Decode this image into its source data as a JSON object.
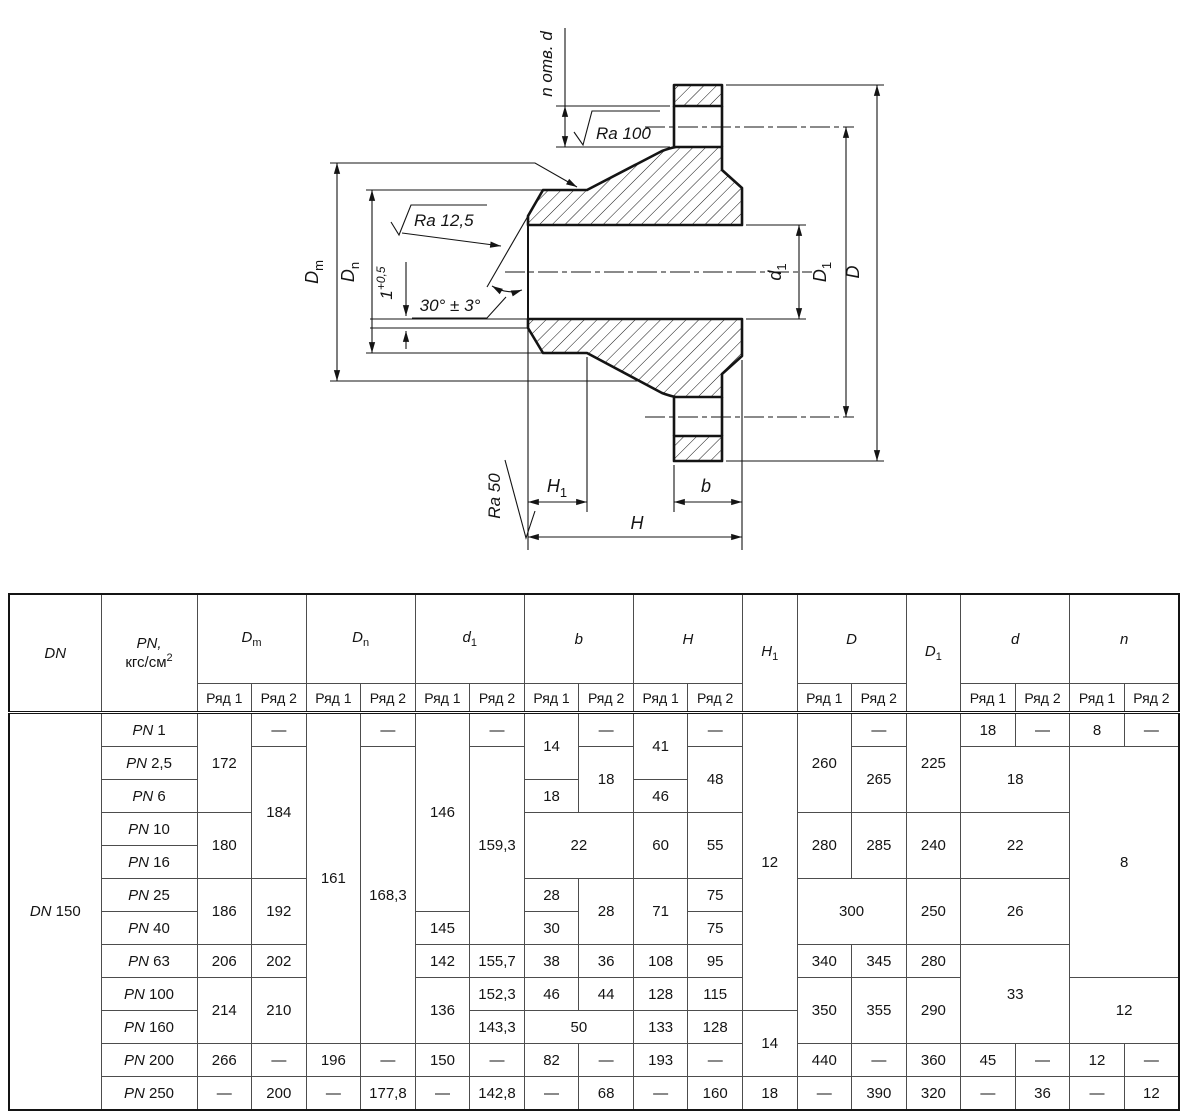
{
  "drawing": {
    "callouts": {
      "holes": "n отв. d",
      "ra_spotface": "Ra 100",
      "ra_bevel": "Ra 12,5",
      "ra_end": "Ra 50",
      "bevel_angle": "30° ± 3°",
      "land": {
        "value": "1",
        "tolerance": "+0,5"
      }
    },
    "dimensions": {
      "dm": {
        "base": "D",
        "sub": "m"
      },
      "dn": {
        "base": "D",
        "sub": "n"
      },
      "d1": {
        "base": "d",
        "sub": "1"
      },
      "b": {
        "base": "b",
        "sub": ""
      },
      "h": {
        "base": "H",
        "sub": ""
      },
      "h1": {
        "base": "H",
        "sub": "1"
      },
      "dbig": {
        "base": "D",
        "sub": ""
      },
      "dbig1": {
        "base": "D",
        "sub": "1"
      }
    }
  },
  "table": {
    "dn": {
      "prefix": "DN",
      "value": "150"
    },
    "header": {
      "dn": "DN",
      "pn_line1": "PN,",
      "pn_line2": "кгс/см",
      "pn_sup": "2",
      "row_labels": [
        "Ряд 1",
        "Ряд 2"
      ],
      "groups": [
        {
          "base": "D",
          "sub": "m",
          "split": true
        },
        {
          "base": "D",
          "sub": "n",
          "split": true
        },
        {
          "base": "d",
          "sub": "1",
          "split": true
        },
        {
          "base": "b",
          "sub": "",
          "split": true
        },
        {
          "base": "H",
          "sub": "",
          "split": true
        },
        {
          "base": "H",
          "sub": "1",
          "split": false
        },
        {
          "base": "D",
          "sub": "",
          "split": true
        },
        {
          "base": "D",
          "sub": "1",
          "split": false
        },
        {
          "base": "d",
          "sub": "",
          "split": true
        },
        {
          "base": "n",
          "sub": "",
          "split": true
        }
      ]
    },
    "rows": [
      {
        "pn_prefix": "PN",
        "pn_value": "1",
        "cells": [
          {
            "v": "172",
            "rs": 3
          },
          {
            "v": "—"
          },
          {
            "v": "161",
            "rs": 10
          },
          {
            "v": "—"
          },
          {
            "v": "146",
            "rs": 6
          },
          {
            "v": "—"
          },
          {
            "v": "14",
            "rs": 2
          },
          {
            "v": "—"
          },
          {
            "v": "41",
            "rs": 2
          },
          {
            "v": "—"
          },
          {
            "v": "12",
            "rs": 9
          },
          {
            "v": "260",
            "rs": 3
          },
          {
            "v": "—"
          },
          {
            "v": "225",
            "rs": 3
          },
          {
            "v": "18"
          },
          {
            "v": "—"
          },
          {
            "v": "8"
          },
          {
            "v": "—"
          }
        ]
      },
      {
        "pn_prefix": "PN",
        "pn_value": "2,5",
        "cells": [
          {
            "v": "184",
            "rs": 4
          },
          {
            "v": "168,3",
            "rs": 9
          },
          {
            "v": "159,3",
            "rs": 6
          },
          {
            "v": "18",
            "rs": 2
          },
          {
            "v": "48",
            "rs": 2
          },
          {
            "v": "265",
            "rs": 2
          },
          {
            "v": "18",
            "cs": 2,
            "rs": 2
          },
          {
            "v": "8",
            "cs": 2,
            "rs": 7
          }
        ]
      },
      {
        "pn_prefix": "PN",
        "pn_value": "6",
        "cells": [
          {
            "v": "18"
          },
          {
            "v": "46"
          }
        ]
      },
      {
        "pn_prefix": "PN",
        "pn_value": "10",
        "cells": [
          {
            "v": "180",
            "rs": 2
          },
          {
            "v": "22",
            "cs": 2,
            "rs": 2
          },
          {
            "v": "60",
            "rs": 2
          },
          {
            "v": "55",
            "rs": 2
          },
          {
            "v": "280",
            "rs": 2
          },
          {
            "v": "285",
            "rs": 2
          },
          {
            "v": "240",
            "rs": 2
          },
          {
            "v": "22",
            "cs": 2,
            "rs": 2
          }
        ]
      },
      {
        "pn_prefix": "PN",
        "pn_value": "16",
        "cells": []
      },
      {
        "pn_prefix": "PN",
        "pn_value": "25",
        "cells": [
          {
            "v": "186",
            "rs": 2
          },
          {
            "v": "192",
            "rs": 2
          },
          {
            "v": "28"
          },
          {
            "v": "28",
            "rs": 2
          },
          {
            "v": "71",
            "rs": 2
          },
          {
            "v": "75"
          },
          {
            "v": "300",
            "cs": 2,
            "rs": 2
          },
          {
            "v": "250",
            "rs": 2
          },
          {
            "v": "26",
            "cs": 2,
            "rs": 2
          }
        ]
      },
      {
        "pn_prefix": "PN",
        "pn_value": "40",
        "cells": [
          {
            "v": "145"
          },
          {
            "v": "30"
          },
          {
            "v": "75"
          }
        ]
      },
      {
        "pn_prefix": "PN",
        "pn_value": "63",
        "cells": [
          {
            "v": "206"
          },
          {
            "v": "202"
          },
          {
            "v": "142"
          },
          {
            "v": "155,7"
          },
          {
            "v": "38"
          },
          {
            "v": "36"
          },
          {
            "v": "108"
          },
          {
            "v": "95"
          },
          {
            "v": "340"
          },
          {
            "v": "345"
          },
          {
            "v": "280"
          },
          {
            "v": "33",
            "cs": 2,
            "rs": 3
          }
        ]
      },
      {
        "pn_prefix": "PN",
        "pn_value": "100",
        "cells": [
          {
            "v": "214",
            "rs": 2
          },
          {
            "v": "210",
            "rs": 2
          },
          {
            "v": "136",
            "rs": 2
          },
          {
            "v": "152,3"
          },
          {
            "v": "46"
          },
          {
            "v": "44"
          },
          {
            "v": "128"
          },
          {
            "v": "115"
          },
          {
            "v": "350",
            "rs": 2
          },
          {
            "v": "355",
            "rs": 2
          },
          {
            "v": "290",
            "rs": 2
          },
          {
            "v": "12",
            "cs": 2,
            "rs": 2
          }
        ]
      },
      {
        "pn_prefix": "PN",
        "pn_value": "160",
        "cells": [
          {
            "v": "143,3"
          },
          {
            "v": "50",
            "cs": 2
          },
          {
            "v": "133"
          },
          {
            "v": "128"
          },
          {
            "v": "14",
            "rs": 2
          }
        ]
      },
      {
        "pn_prefix": "PN",
        "pn_value": "200",
        "cells": [
          {
            "v": "266"
          },
          {
            "v": "—"
          },
          {
            "v": "196"
          },
          {
            "v": "—"
          },
          {
            "v": "150"
          },
          {
            "v": "—"
          },
          {
            "v": "82"
          },
          {
            "v": "—"
          },
          {
            "v": "193"
          },
          {
            "v": "—"
          },
          {
            "v": "440"
          },
          {
            "v": "—"
          },
          {
            "v": "360"
          },
          {
            "v": "45"
          },
          {
            "v": "—"
          },
          {
            "v": "12"
          },
          {
            "v": "—"
          }
        ]
      },
      {
        "pn_prefix": "PN",
        "pn_value": "250",
        "cells": [
          {
            "v": "—"
          },
          {
            "v": "200"
          },
          {
            "v": "—"
          },
          {
            "v": "177,8"
          },
          {
            "v": "—"
          },
          {
            "v": "142,8"
          },
          {
            "v": "—"
          },
          {
            "v": "68"
          },
          {
            "v": "—"
          },
          {
            "v": "160"
          },
          {
            "v": "18"
          },
          {
            "v": "—"
          },
          {
            "v": "390"
          },
          {
            "v": "320"
          },
          {
            "v": "—"
          },
          {
            "v": "36"
          },
          {
            "v": "—"
          },
          {
            "v": "12"
          }
        ]
      }
    ]
  }
}
